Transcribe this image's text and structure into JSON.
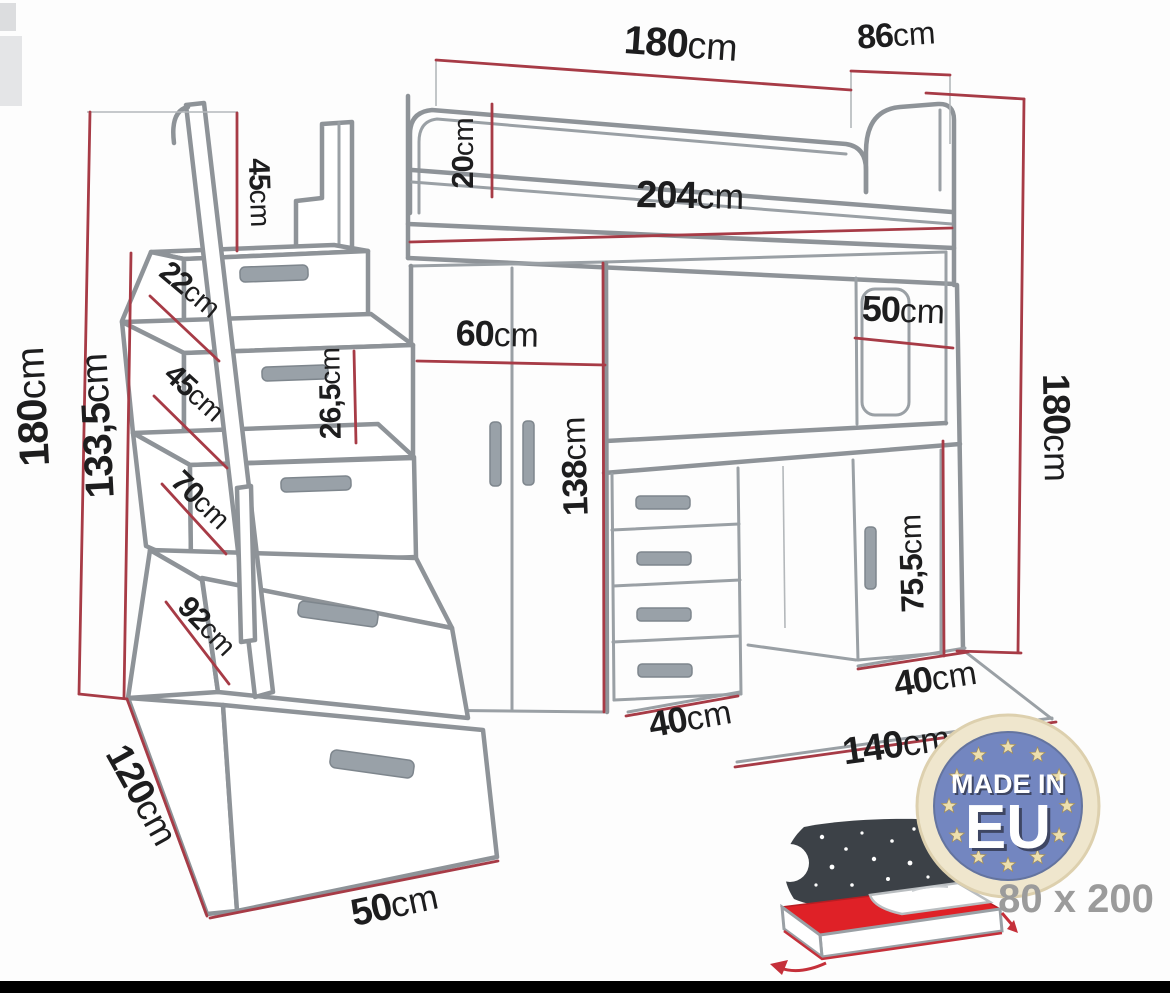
{
  "title": "loft-bed furniture dimension diagram",
  "colors": {
    "dimension_line": "#a73b46",
    "furniture_outline": "#8e9398",
    "label_text": "#1d1d1e",
    "badge_blue": "#7386c0",
    "badge_ring": "#efe6cd",
    "badge_stars": "#eddfae",
    "mattress_red": "#df2127",
    "size_label_gray": "#9b9b9b",
    "bottom_bar": "#000000"
  },
  "dimensions": {
    "bed_length_top": {
      "v": "180",
      "u": "cm"
    },
    "bed_width_top": {
      "v": "86",
      "u": "cm"
    },
    "rail_height": {
      "v": "20",
      "u": "cm"
    },
    "total_length": {
      "v": "204",
      "u": "cm"
    },
    "handrail_height": {
      "v": "45",
      "u": "cm"
    },
    "step1_height": {
      "v": "22",
      "u": "cm"
    },
    "step2_height": {
      "v": "45",
      "u": "cm"
    },
    "step3_height": {
      "v": "70",
      "u": "cm"
    },
    "step4_height": {
      "v": "92",
      "u": "cm"
    },
    "total_height": {
      "v": "180",
      "u": "cm"
    },
    "platform_height": {
      "v": "133,5",
      "u": "cm"
    },
    "step_face_height": {
      "v": "26,5",
      "u": "cm"
    },
    "wardrobe_width": {
      "v": "60",
      "u": "cm"
    },
    "underbed_height": {
      "v": "138",
      "u": "cm"
    },
    "shelf_width": {
      "v": "50",
      "u": "cm"
    },
    "right_height": {
      "v": "180",
      "u": "cm"
    },
    "cabinet_height": {
      "v": "75,5",
      "u": "cm"
    },
    "stairs_depth": {
      "v": "120",
      "u": "cm"
    },
    "stairs_width": {
      "v": "50",
      "u": "cm"
    },
    "desk_depth": {
      "v": "40",
      "u": "cm"
    },
    "cabinet_depth": {
      "v": "40",
      "u": "cm"
    },
    "desk_width": {
      "v": "140",
      "u": "cm"
    }
  },
  "badge": {
    "line1": "MADE IN",
    "line2": "EU"
  },
  "mattress_size_label": "80 x 200"
}
